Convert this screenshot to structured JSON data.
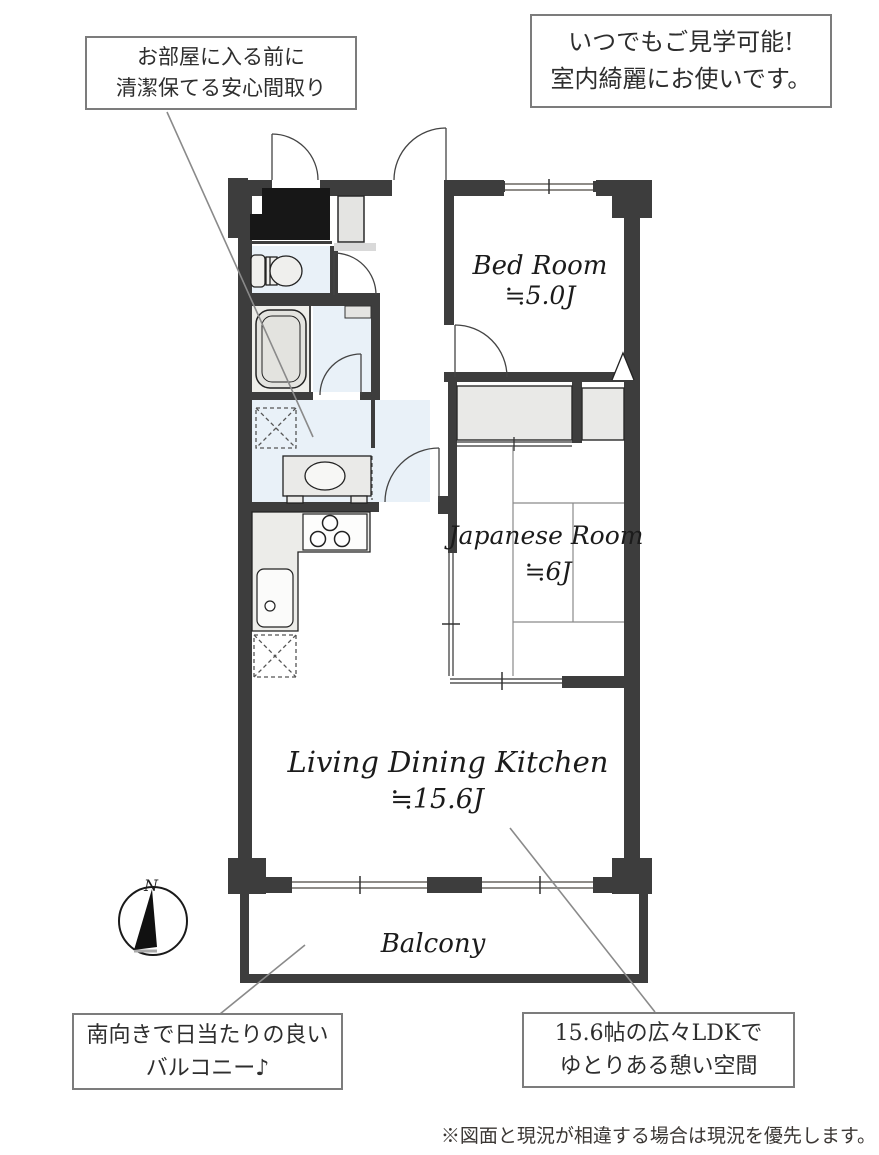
{
  "callouts": {
    "top_left": {
      "line1": "お部屋に入る前に",
      "line2": "清潔保てる安心間取り"
    },
    "top_right": {
      "line1": "いつでもご見学可能!",
      "line2": "室内綺麗にお使いです。"
    },
    "bottom_left": {
      "line1": "南向きで日当たりの良い",
      "line2": "バルコニー♪"
    },
    "bottom_right": {
      "line1": "15.6帖の広々LDKで",
      "line2": "ゆとりある憩い空間"
    }
  },
  "rooms": {
    "bedroom": {
      "name": "Bed Room",
      "size": "≒5.0J"
    },
    "japanese_room": {
      "name": "Japanese Room",
      "size": "≒6J"
    },
    "ldk": {
      "name": "Living Dining Kitchen",
      "size": "≒15.6J"
    },
    "balcony": {
      "name": "Balcony"
    }
  },
  "compass": {
    "label": "N"
  },
  "footnote": "※図面と現況が相違する場合は現況を優先します。",
  "colors": {
    "wall": "#3d3d3d",
    "genkan": "#171717",
    "fixture_fill": "#e9e9e7",
    "water_floor": "#e9f1f8",
    "window_line": "#8f8c88",
    "leader_line": "#8a8a8a",
    "callout_border": "#7c7c7c"
  }
}
